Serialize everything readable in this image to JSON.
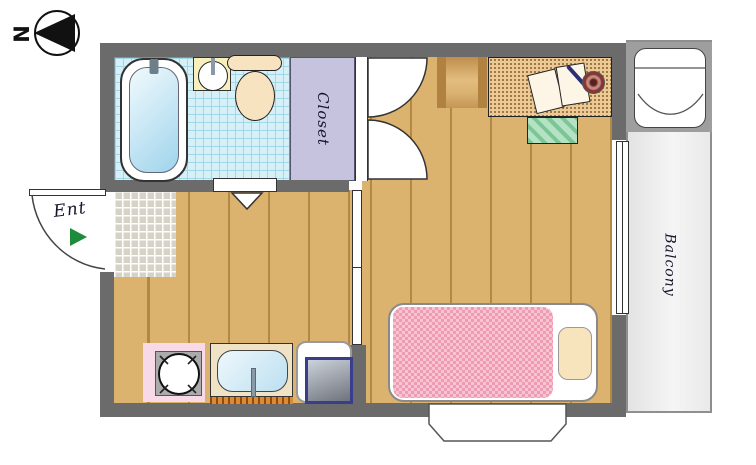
{
  "compass": {
    "label": "N",
    "points_to": "left"
  },
  "labels": {
    "entrance": "Ent",
    "closet": "Closet",
    "balcony": "Balcony"
  },
  "rooms": [
    {
      "name": "bathroom",
      "features": [
        "bathtub",
        "wash-basin",
        "toilet"
      ]
    },
    {
      "name": "kitchen-dining",
      "features": [
        "genkan-entry-tile",
        "stove-burner",
        "kitchen-sink",
        "refrigerator"
      ]
    },
    {
      "name": "bedroom",
      "features": [
        "desk",
        "book",
        "pen",
        "cup",
        "chair",
        "floor-cushion",
        "bed",
        "blanket",
        "pillow",
        "bay-window",
        "closet-double-doors"
      ]
    },
    {
      "name": "balcony",
      "features": [
        "washing-machine-pan",
        "sliding-glass-door"
      ]
    }
  ],
  "icons": [
    "compass-needle-icon",
    "entry-arrow-icon",
    "door-swing-arc-icon",
    "double-door-arc-icon",
    "door-triangle-icon",
    "burner-icon"
  ],
  "colors": {
    "wall": "#6b6b6b",
    "wood_floor": "#dcb26f",
    "plank_line": "#b08a45",
    "bathroom_tile": "#d7f0f8",
    "tile_line": "#9fd9e8",
    "closet_fill": "#c6c3df",
    "genkan_tile": "#d6d2c6",
    "blanket_pink": "#ee9cb4",
    "pillow_cream": "#f7e4bd",
    "desk_wood": "#ecca95",
    "cushion_green": "#8fce9f",
    "stove_pink": "#f7d9e7",
    "counter_beige": "#f0e2c4",
    "drainboard_orange": "#e08a30",
    "appliance_navy": "#383d8c",
    "balcony_gray": "#ececec",
    "entry_arrow_green": "#1e8c3a",
    "water_blue": "#9fd4ec"
  }
}
